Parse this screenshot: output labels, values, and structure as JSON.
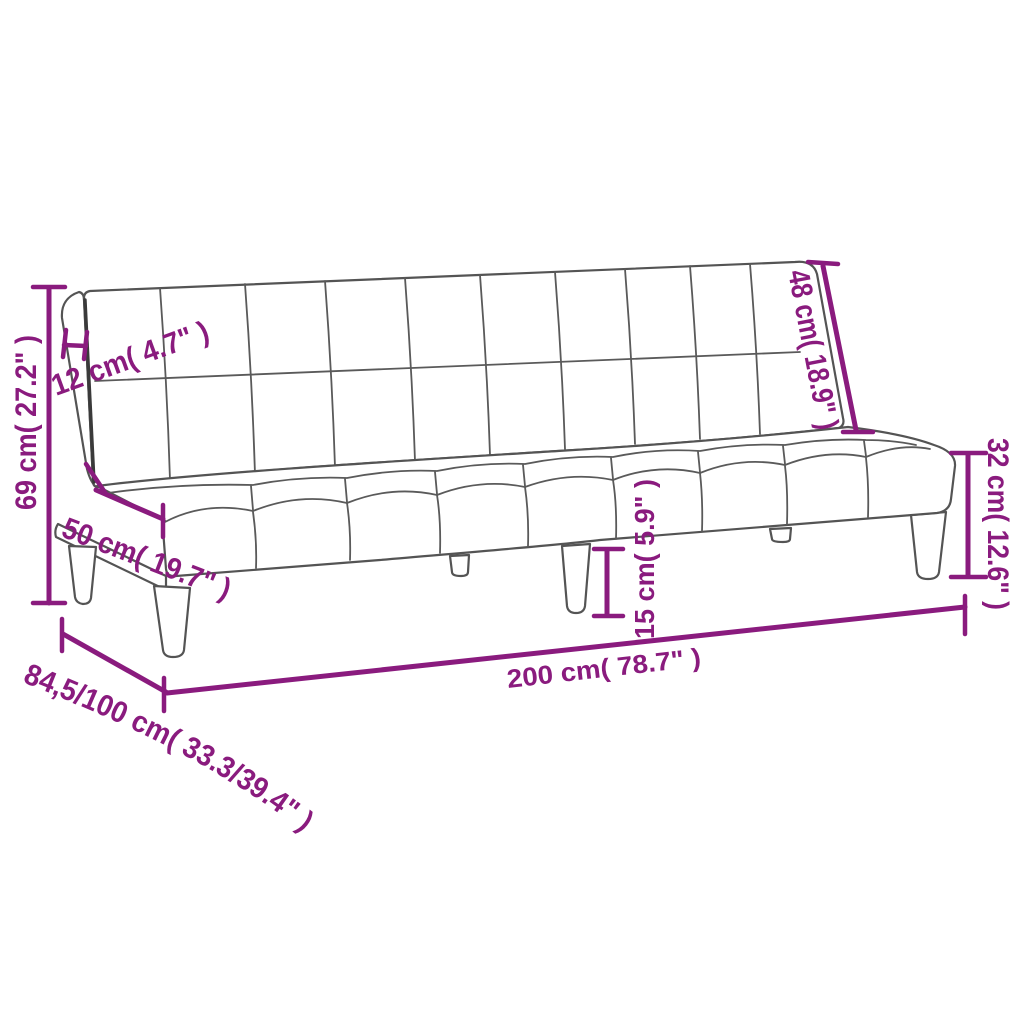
{
  "diagram": {
    "type": "product-dimension-drawing",
    "subject": "sofa-bed",
    "style": {
      "accent_color": "#8a1b7e",
      "outline_color": "#545454",
      "background_color": "#ffffff"
    },
    "dims": {
      "overall_height": {
        "cm": "69",
        "inch": "27.2",
        "label": "69 cm( 27.2\" )"
      },
      "backrest_thickness": {
        "cm": "12",
        "inch": "4.7",
        "label": "12 cm( 4.7\" )"
      },
      "seat_depth": {
        "cm": "50",
        "inch": "19.7",
        "label": "50 cm( 19.7\" )"
      },
      "backrest_height": {
        "cm": "48",
        "inch": "18.9",
        "label": "48 cm( 18.9\" )"
      },
      "seat_height": {
        "cm": "32",
        "inch": "12.6",
        "label": "32 cm( 12.6\" )"
      },
      "leg_height": {
        "cm": "15",
        "inch": "5.9",
        "label": "15 cm( 5.9\" )"
      },
      "overall_width": {
        "cm": "200",
        "inch": "78.7",
        "label": "200 cm( 78.7\" )"
      },
      "overall_depth": {
        "cm": "84,5/100",
        "inch": "33.3/39.4",
        "label": "84,5/100 cm( 33.3/39.4\" )"
      }
    }
  }
}
